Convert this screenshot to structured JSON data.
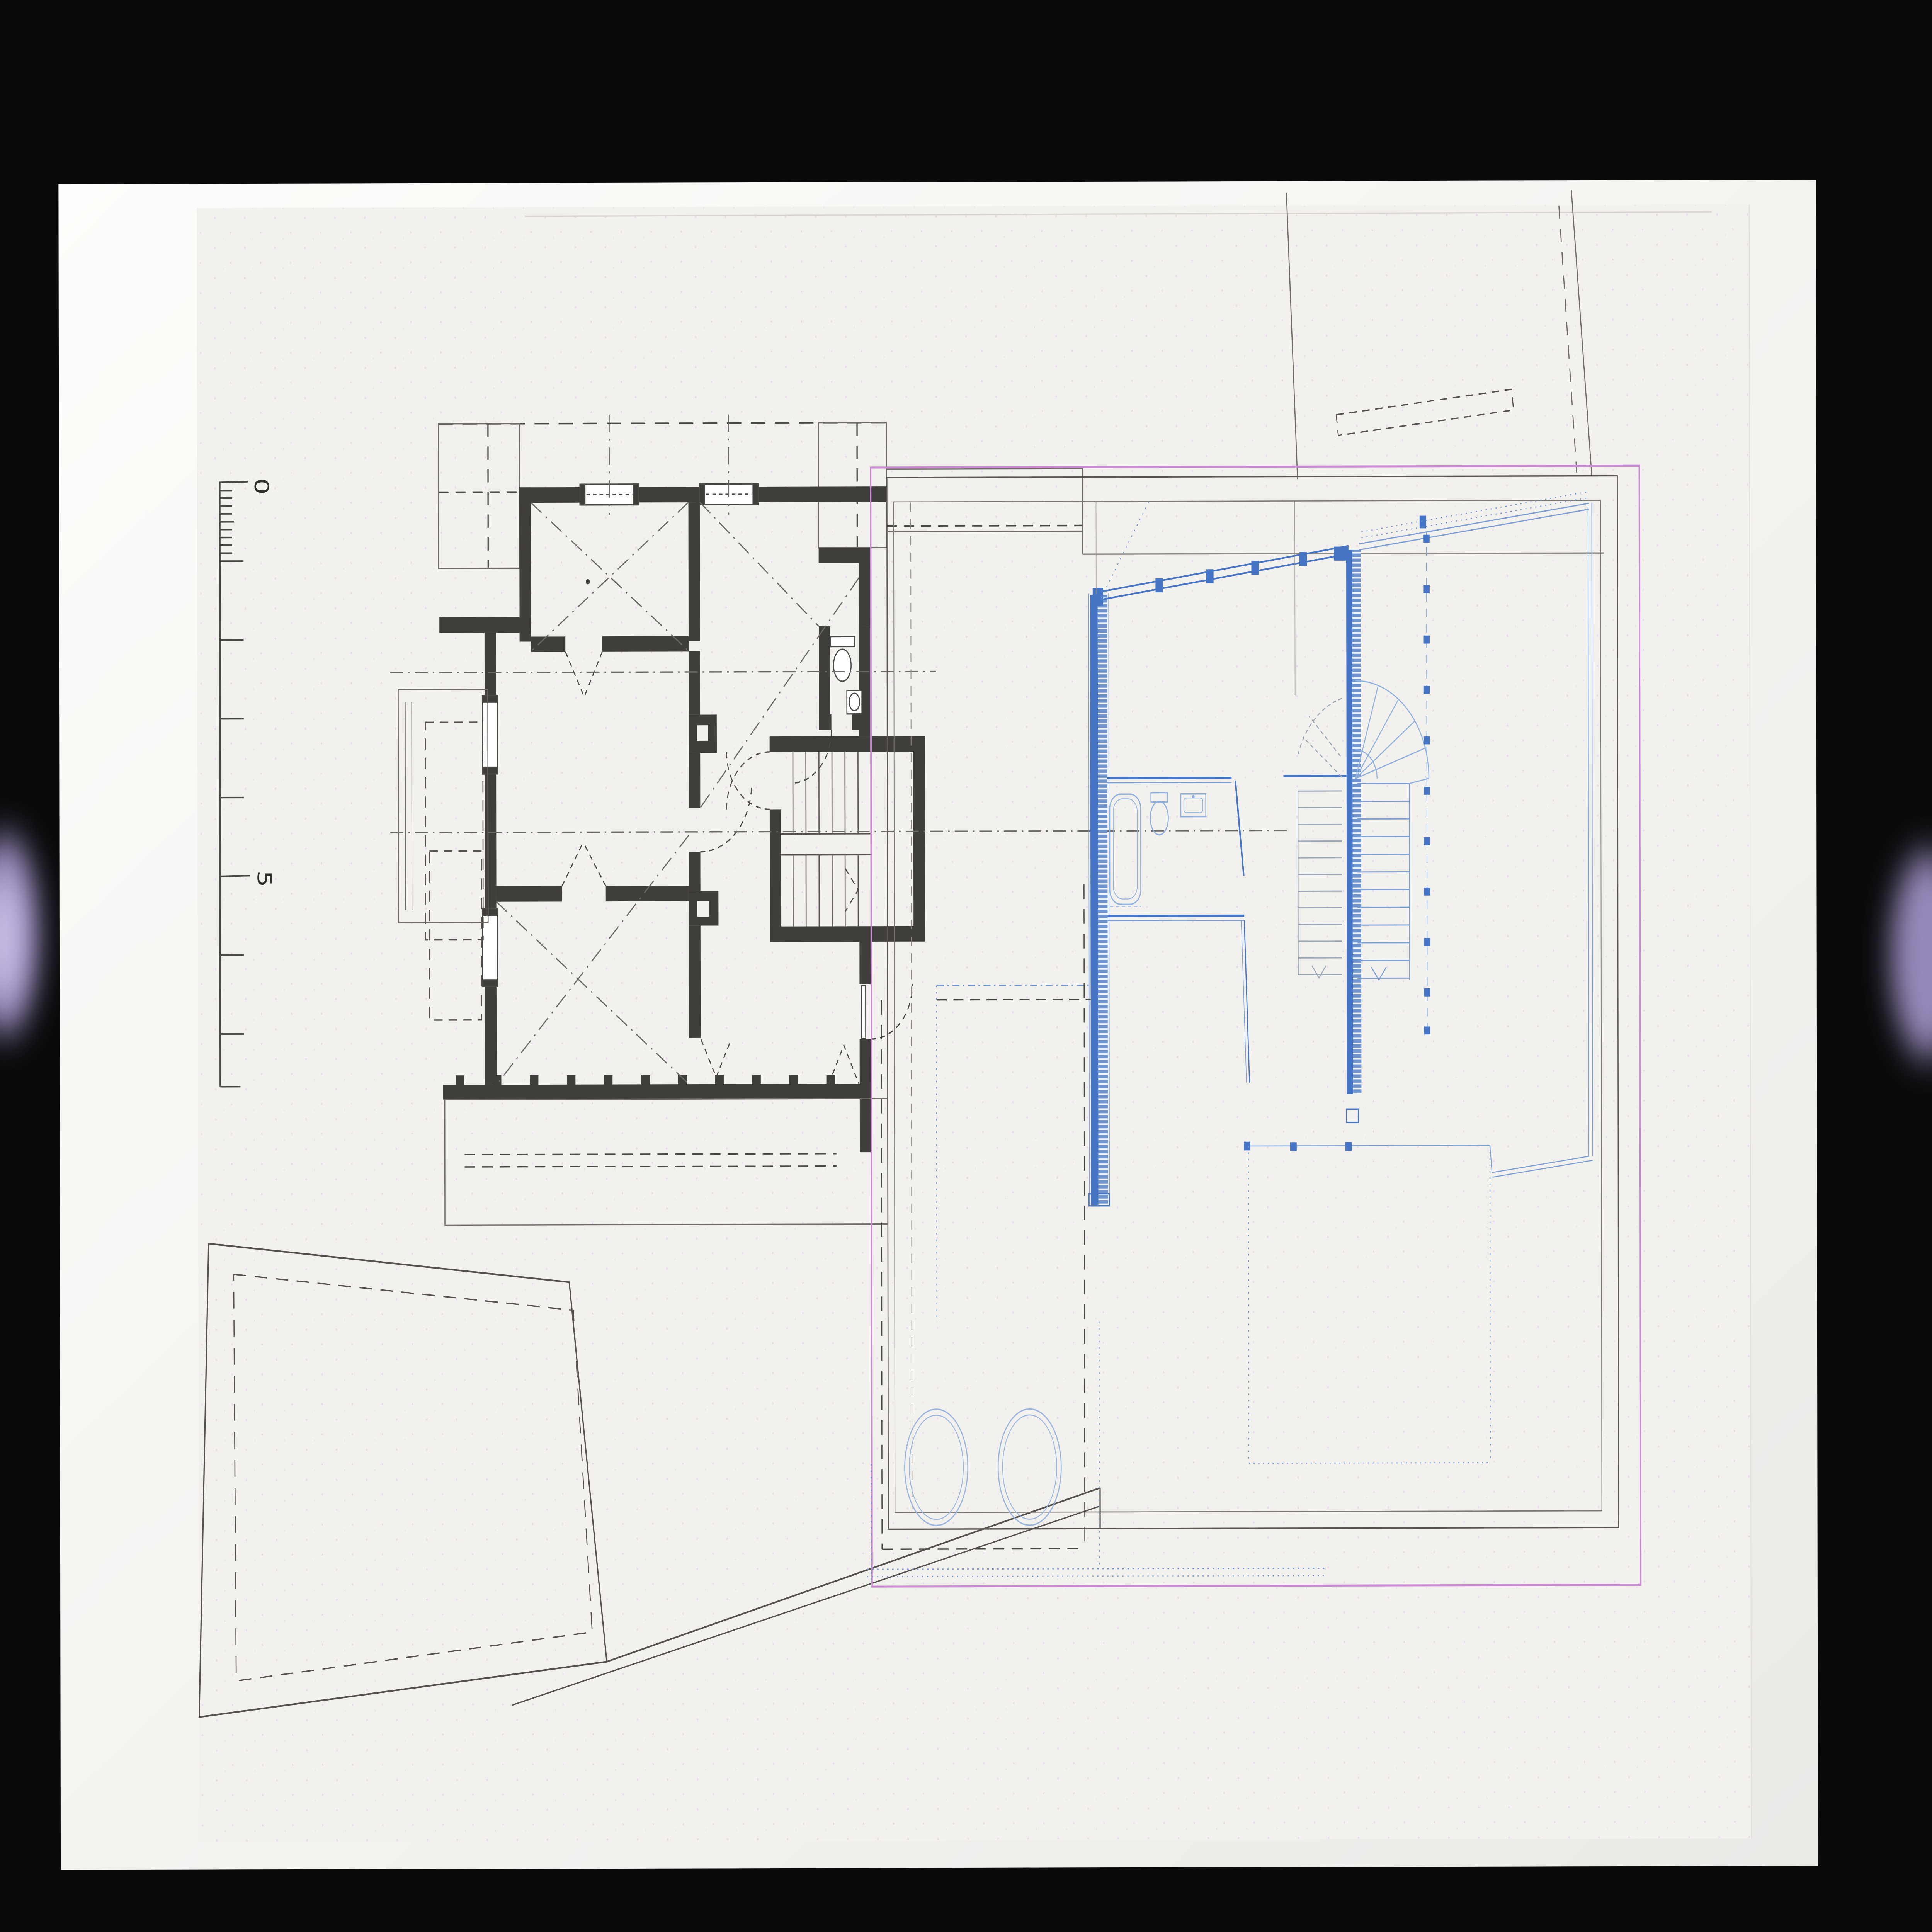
{
  "scale_bar": {
    "label_top": "0",
    "label_mid": "5"
  },
  "colors": {
    "scanner_bed": "#0a0a0b",
    "paper": "#f5f4f1",
    "existing_plan_ink": "#403e3a",
    "new_plan_blue": "#4575c4",
    "pale_blue": "#8fb0dd",
    "tread_gray": "#9aa7b5",
    "pink_border": "#c98ad3",
    "scanner_flare_purple": "#b9a9e6"
  }
}
